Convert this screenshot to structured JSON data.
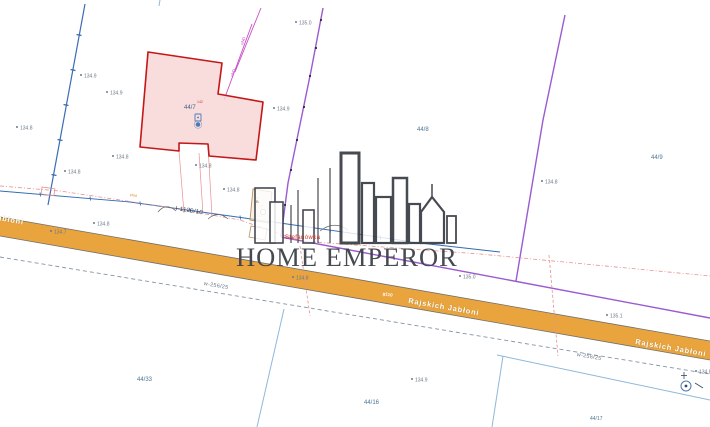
{
  "watermark": {
    "brand": "HOME EMPEROR"
  },
  "road": {
    "name": "Rajskich Jabłoni",
    "name_left_partial": "abłoni",
    "surface_code": "g110"
  },
  "place": {
    "name": "Stefanówka"
  },
  "utility_labels": {
    "pipeline": "I-1120/10",
    "water_left": "w-256/25",
    "water_right": "w-256/25",
    "power_1": "eND",
    "power_2": "eND",
    "power_small": "eNd"
  },
  "parcels": {
    "highlighted": {
      "number": "44/7",
      "point_code": "142"
    },
    "labels": [
      "44/8",
      "44/9",
      "44/33",
      "44/16",
      "44/17"
    ],
    "building_label": "B"
  },
  "elevations": [
    "135.0",
    "134.9",
    "134.9",
    "134.9",
    "134.8",
    "134.8",
    "134.8",
    "134.8",
    "134.8",
    "134.7",
    "134.8",
    "135.0",
    "134.8",
    "135.1",
    "134.9",
    "134.8",
    "134.8"
  ],
  "colors": {
    "road-fill": "#e9a43d",
    "road-edge": "#6f6f6f",
    "parcel-fill": "#f8d7d7",
    "parcel-stroke": "#c41717",
    "boundary-blue": "#3c6cb4",
    "boundary-light": "#8fb8da",
    "line-blue": "#2f6cb5",
    "line-purple": "#9a5ad0",
    "line-magenta": "#c84ec8",
    "line-salmon": "#e89090",
    "dash-gray": "#8494a6",
    "building-stroke": "#b98f5e",
    "building-fill": "#f3e6d2",
    "text-elev": "#6b7888",
    "text-parcel": "#4d7596",
    "text-red": "#d52a1e",
    "text-road": "#ffffff",
    "watermark": "#3d4148",
    "marker-blue": "#4a7ab5"
  }
}
